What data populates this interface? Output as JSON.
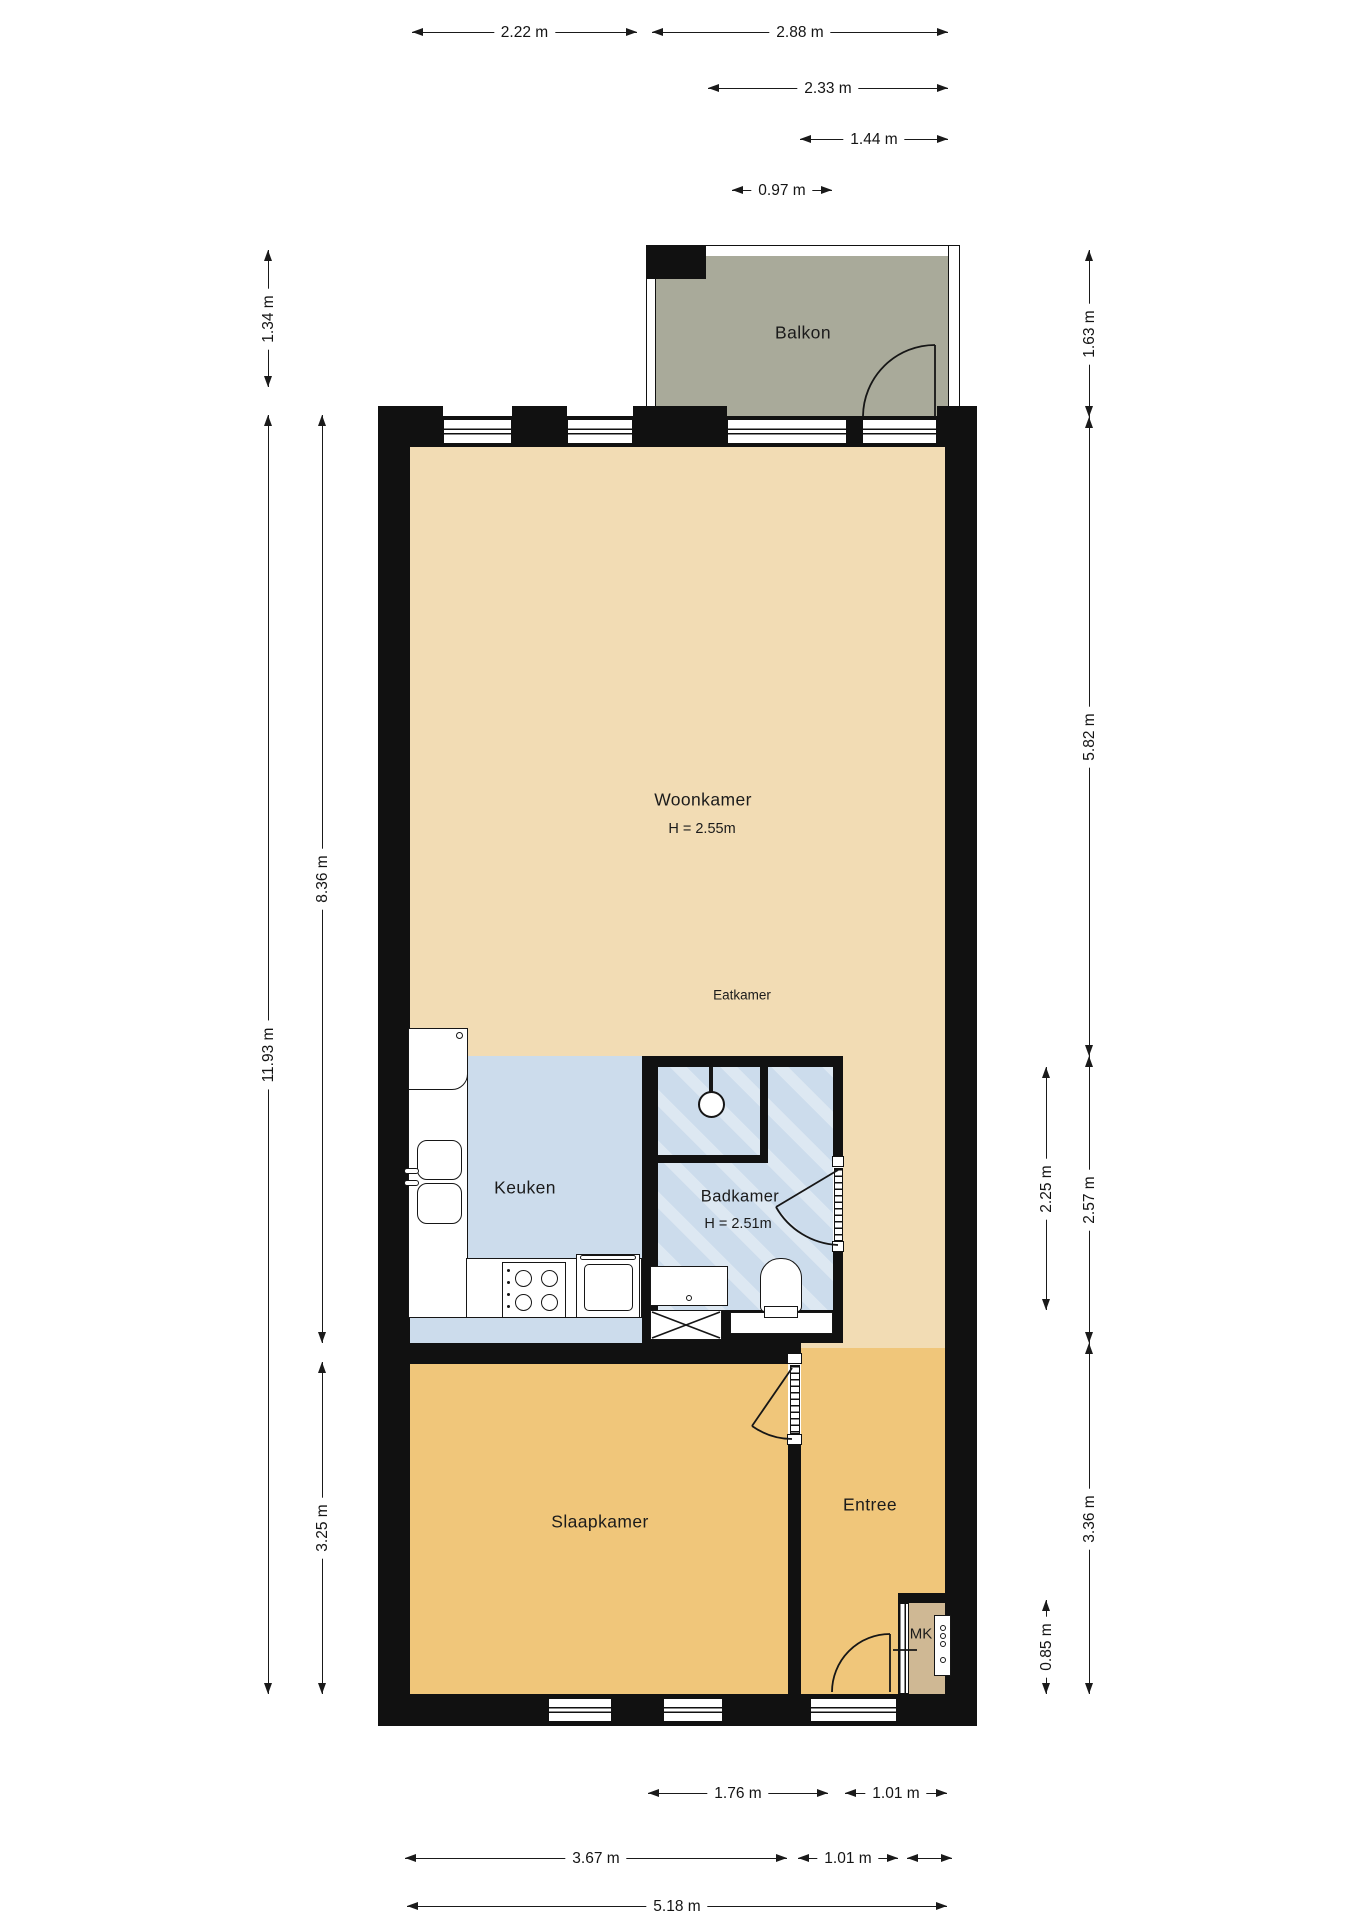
{
  "rooms": {
    "balkon": {
      "label": "Balkon"
    },
    "woonkamer": {
      "label": "Woonkamer",
      "height": "H = 2.55m"
    },
    "eatkamer": {
      "label": "Eatkamer"
    },
    "keuken": {
      "label": "Keuken"
    },
    "badkamer": {
      "label": "Badkamer",
      "height": "H = 2.51m"
    },
    "slaapkamer": {
      "label": "Slaapkamer"
    },
    "entree": {
      "label": "Entree"
    },
    "mk": {
      "label": "MK"
    }
  },
  "dimensions": {
    "top": [
      {
        "label": "2.22 m"
      },
      {
        "label": "2.88 m"
      },
      {
        "label": "2.33 m"
      },
      {
        "label": "1.44 m"
      },
      {
        "label": "0.97 m"
      }
    ],
    "left": [
      {
        "label": "1.34 m"
      },
      {
        "label": "8.36 m"
      },
      {
        "label": "11.93 m"
      },
      {
        "label": "3.25 m"
      }
    ],
    "right": [
      {
        "label": "1.63 m"
      },
      {
        "label": "5.82 m"
      },
      {
        "label": "2.25 m"
      },
      {
        "label": "2.57 m"
      },
      {
        "label": "3.36 m"
      },
      {
        "label": "0.85 m"
      }
    ],
    "bottom": [
      {
        "label": "1.76 m"
      },
      {
        "label": "1.01 m"
      },
      {
        "label": "3.67 m"
      },
      {
        "label": "1.01 m"
      },
      {
        "label": "5.18 m"
      }
    ]
  },
  "colors": {
    "living": "#f2dcb4",
    "wet": "#ccdcec",
    "bedroom": "#f0c67a",
    "balcony": "#a9aa9a",
    "closet": "#cfb894",
    "wall": "#111111"
  }
}
